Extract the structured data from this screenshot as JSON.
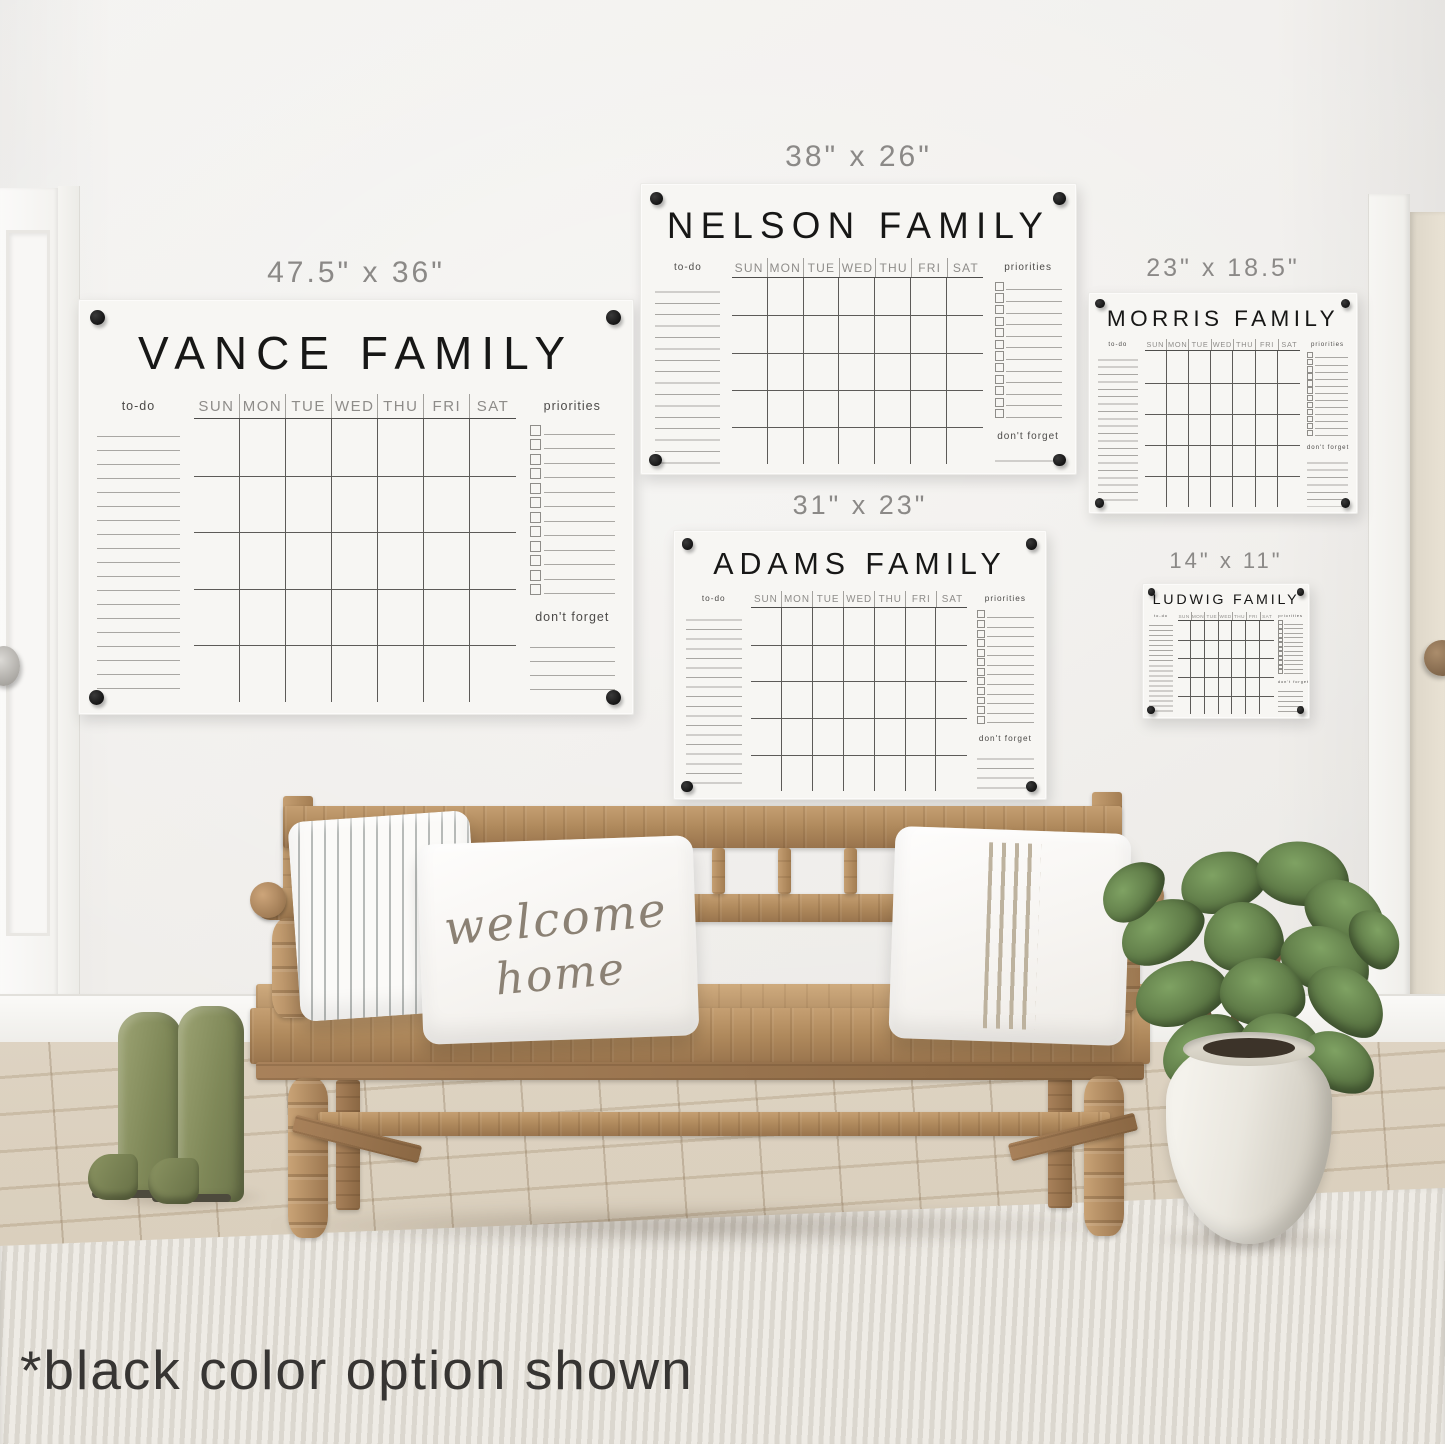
{
  "footnote": "*black color option shown",
  "day_headers": [
    "SUN",
    "MON",
    "TUE",
    "WED",
    "THU",
    "FRI",
    "SAT"
  ],
  "boards": [
    {
      "title": "VANCE FAMILY",
      "size_label": "47.5\" x 36\"",
      "todo_label": "to-do",
      "priorities_label": "priorities",
      "dont_forget_label": "don't forget"
    },
    {
      "title": "NELSON FAMILY",
      "size_label": "38\" x 26\"",
      "todo_label": "to-do",
      "priorities_label": "priorities",
      "dont_forget_label": "don't forget"
    },
    {
      "title": "ADAMS FAMILY",
      "size_label": "31\" x 23\"",
      "todo_label": "to-do",
      "priorities_label": "priorities",
      "dont_forget_label": "don't forget"
    },
    {
      "title": "MORRIS FAMILY",
      "size_label": "23\" x 18.5\"",
      "todo_label": "to-do",
      "priorities_label": "priorities",
      "dont_forget_label": "don't forget"
    },
    {
      "title": "LUDWIG FAMILY",
      "size_label": "14\" x 11\"",
      "todo_label": "to-do",
      "priorities_label": "priorities",
      "dont_forget_label": "don't forget"
    }
  ],
  "pillow": {
    "line1": "welcome",
    "line2": "home"
  },
  "colors": {
    "print_black": "#1a1a1a",
    "wood": "#b3905f",
    "boots_green": "#87905f",
    "leaf_green": "#5d7a4a",
    "wall": "#f1efec",
    "rug": "#e7e4de"
  }
}
